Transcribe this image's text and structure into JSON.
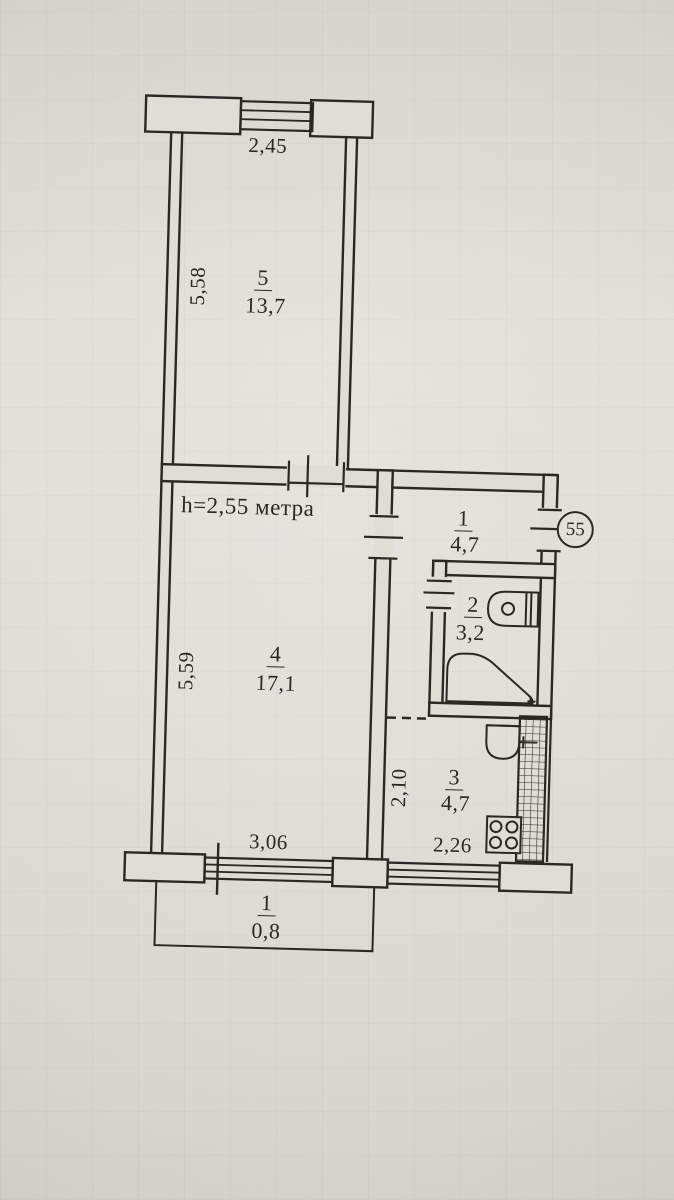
{
  "colors": {
    "paper": "#dfdcd6",
    "ink": "#2a2824"
  },
  "plan": {
    "apartment_badge": "55",
    "ceiling_height": "h=2,55 метра",
    "rooms": {
      "room5": {
        "number": "5",
        "area": "13,7"
      },
      "room4": {
        "number": "4",
        "area": "17,1"
      },
      "hallway": {
        "number": "1",
        "area": "4,7"
      },
      "bathroom": {
        "number": "2",
        "area": "3,2"
      },
      "kitchen": {
        "number": "3",
        "area": "4,7"
      },
      "balcony": {
        "number": "1",
        "area": "0,8"
      }
    },
    "dimensions": {
      "room5_width": "2,45",
      "room5_depth": "5,58",
      "room4_depth": "5,59",
      "room4_width": "3,06",
      "kitchen_depth": "2,10",
      "kitchen_width": "2,26"
    }
  }
}
